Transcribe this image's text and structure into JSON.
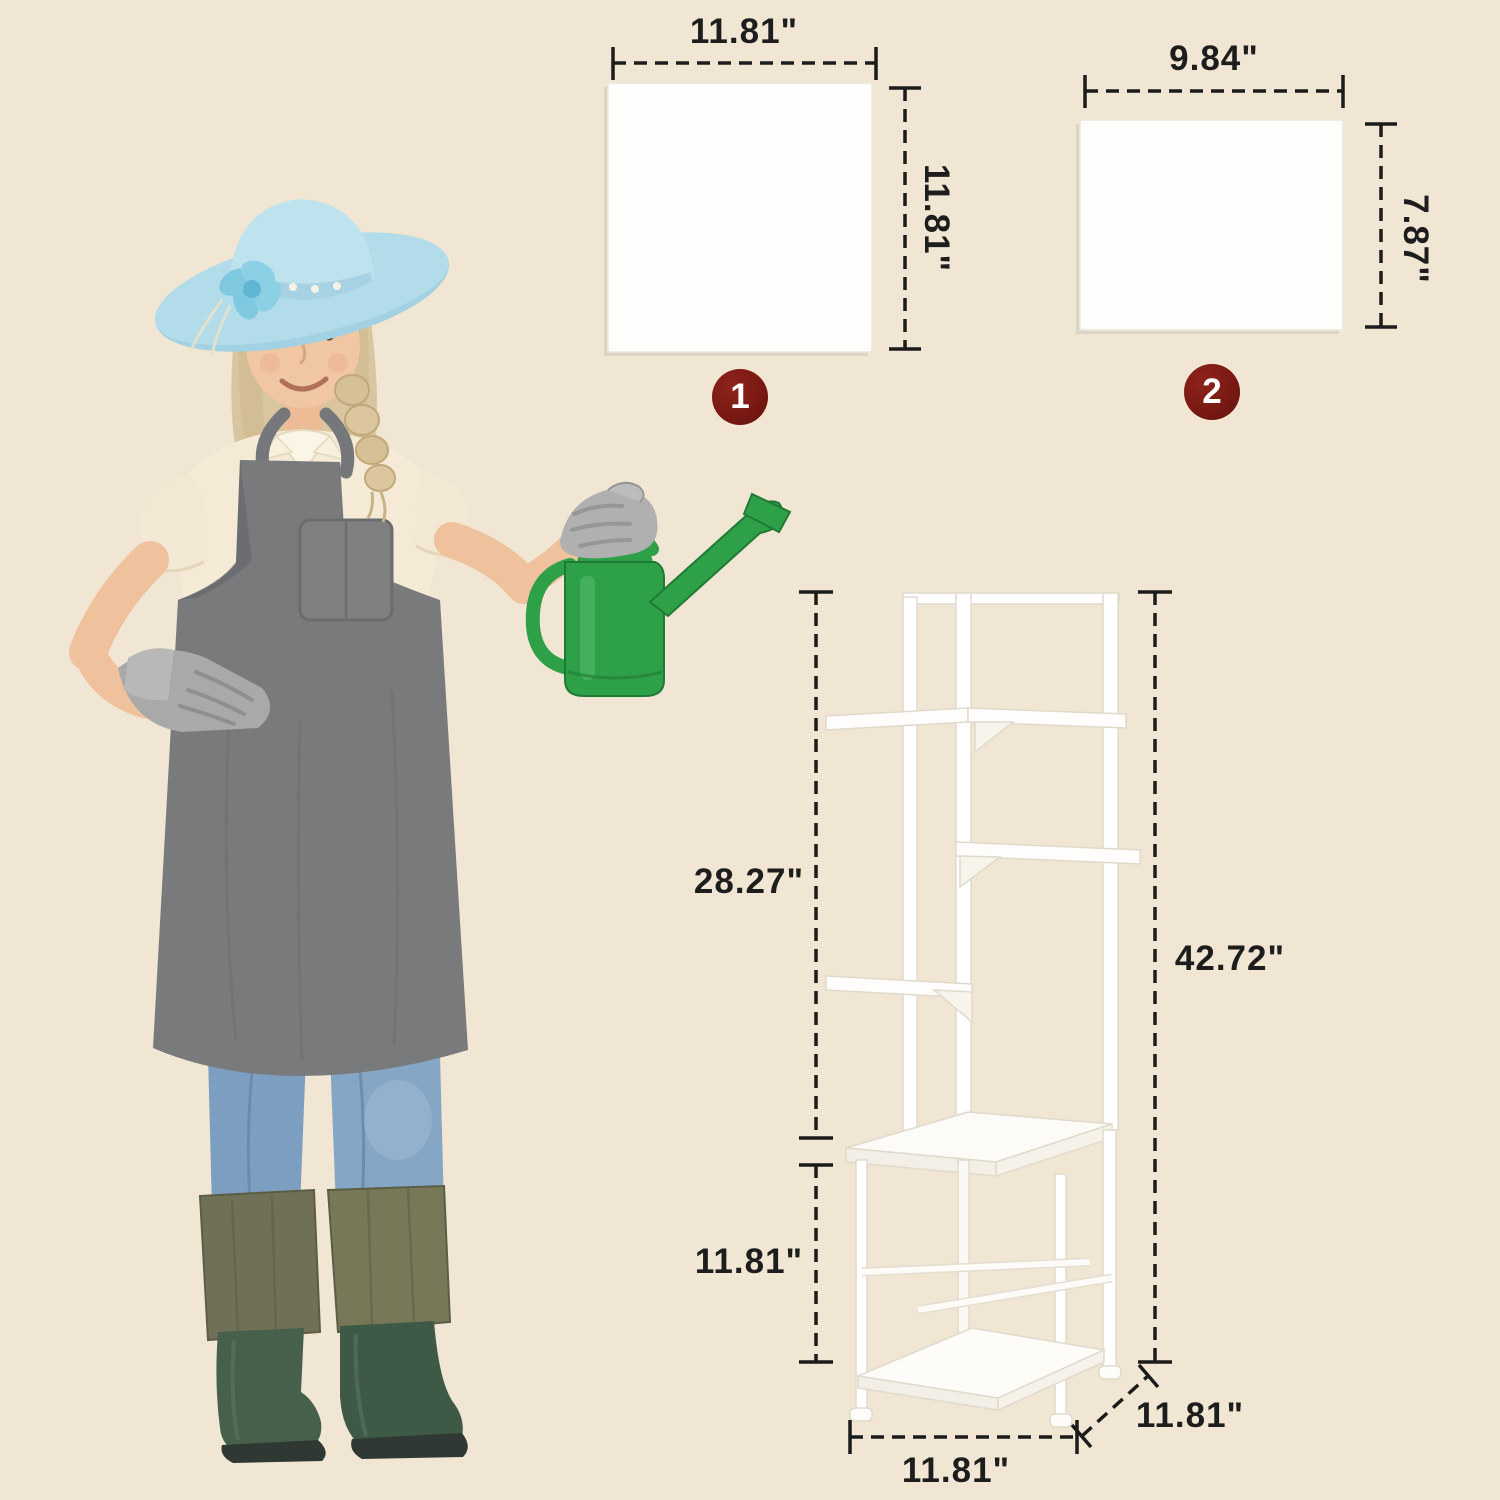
{
  "canvas": {
    "width_px": 1500,
    "height_px": 1500,
    "background_color": "#F0E6D3"
  },
  "palette": {
    "dimension_line": "#1B1B1B",
    "label_text": "#1D1D1D",
    "badge_background": "#7A1913",
    "badge_text": "#FFFFFF",
    "panel_fill": "#FDFDFC",
    "stand_white": "#FFFFFF",
    "watering_can_green": "#2EA047",
    "hat_light_blue": "#B3DCEA",
    "apron_gray": "#797A7C",
    "jeans_blue": "#7C9EC0",
    "boots_green": "#46604C"
  },
  "panels": [
    {
      "badge": "1",
      "width_label": "11.81\"",
      "height_label": "11.81\""
    },
    {
      "badge": "2",
      "width_label": "9.84\"",
      "height_label": "7.87\""
    }
  ],
  "stand": {
    "upper_height_label": "28.27\"",
    "lower_height_label": "11.81\"",
    "total_height_label": "42.72\"",
    "base_width_label": "11.81\"",
    "base_depth_label": "11.81\""
  }
}
